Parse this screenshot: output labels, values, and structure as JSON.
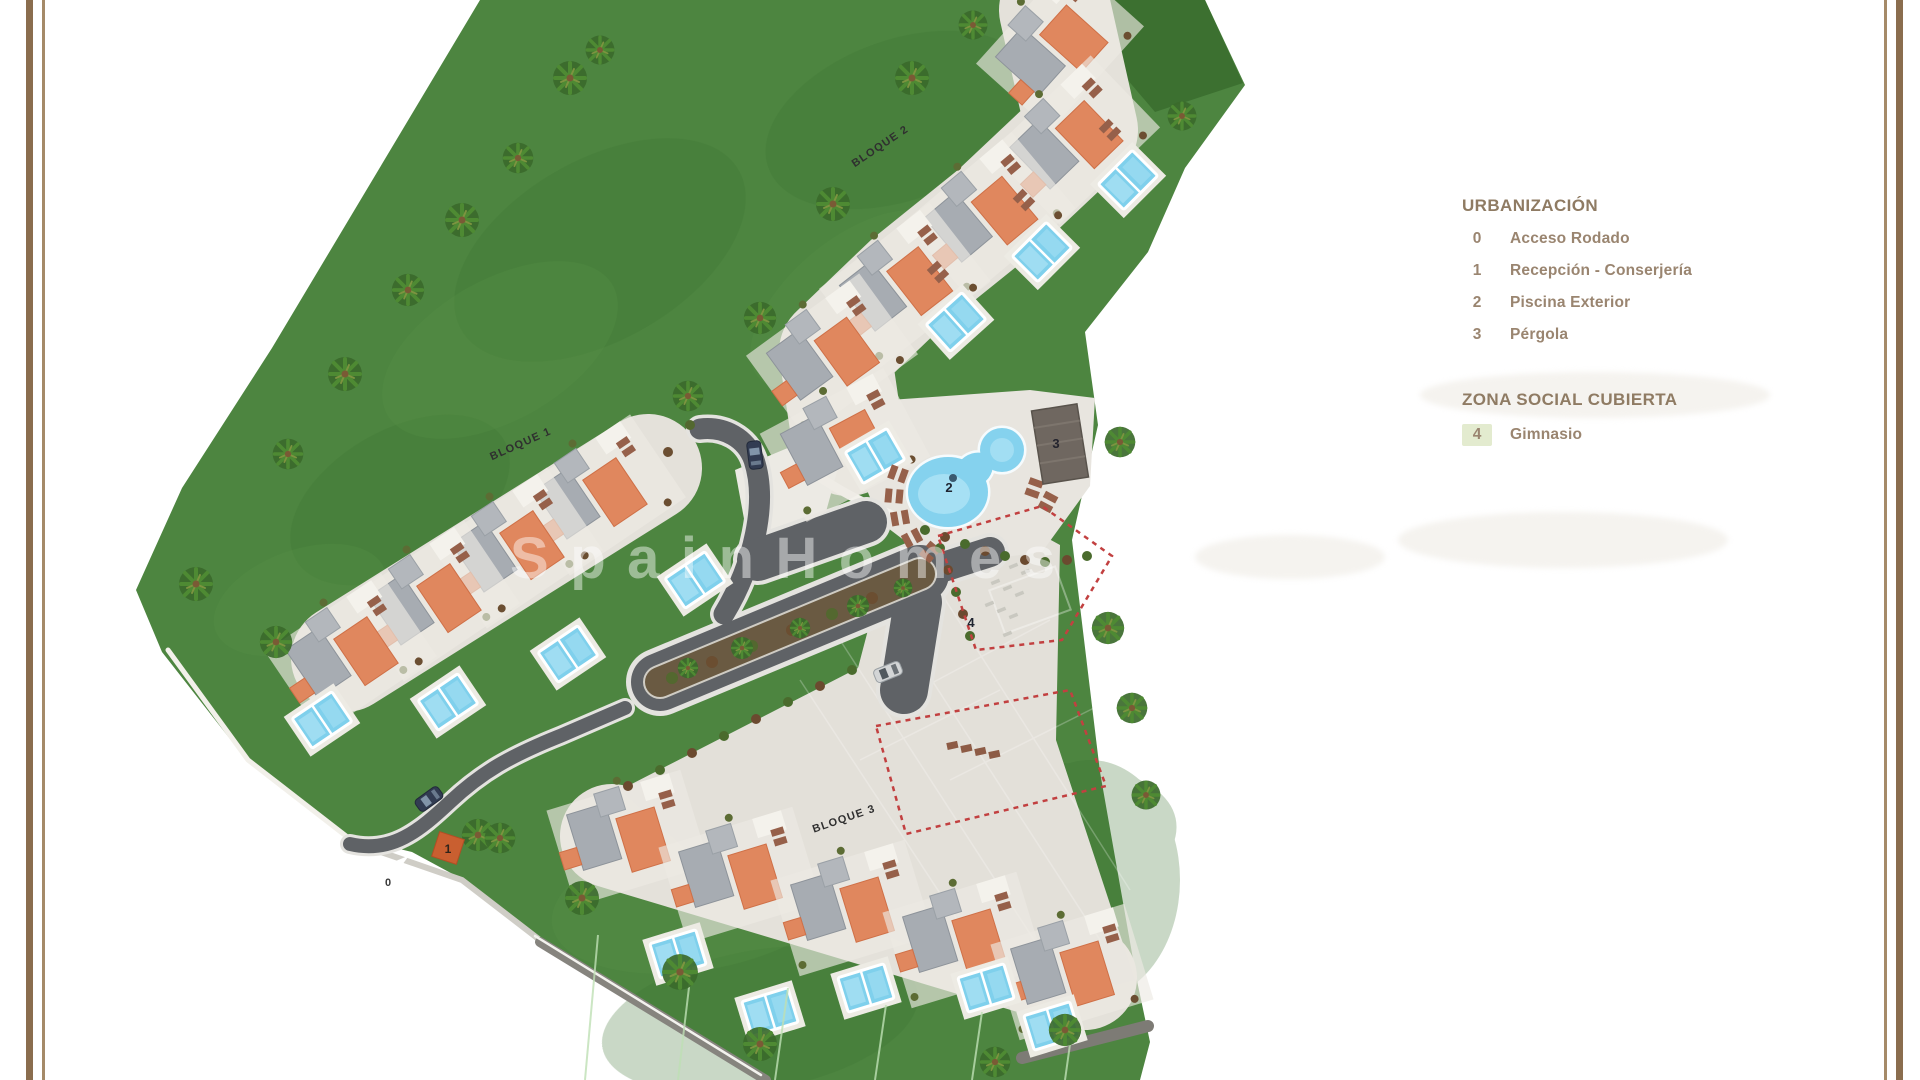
{
  "legend": {
    "title": "URBANIZACIÓN",
    "items": [
      {
        "num": "0",
        "label": "Acceso Rodado"
      },
      {
        "num": "1",
        "label": "Recepción - Conserjería"
      },
      {
        "num": "2",
        "label": "Piscina Exterior"
      },
      {
        "num": "3",
        "label": "Pérgola"
      }
    ],
    "section2_title": "ZONA SOCIAL CUBIERTA",
    "section2_items": [
      {
        "num": "4",
        "label": "Gimnasio"
      }
    ]
  },
  "plan": {
    "block_labels": [
      "BLOQUE 1",
      "BLOQUE 2",
      "BLOQUE 3"
    ],
    "markers": {
      "m0": "0",
      "m1": "1",
      "m2": "2",
      "m3": "3",
      "m4": "4"
    },
    "watermark": "SpainHomes"
  },
  "colors": {
    "frame_brown_thick": "#8a6d4e",
    "frame_brown_thin": "#a58a68",
    "lawn_green": "#4d8540",
    "dark_green_plot": "#3c7030",
    "road_gray": "#5f6266",
    "roof_gray": "#a7acb2",
    "roof_orange": "#e0875e",
    "pool_blue": "#85d2ee",
    "plaza_gray": "#e3e0d9",
    "dashed_zone_red": "#c24040",
    "reception_orange": "#c95f30",
    "legend_text": "#9a8570",
    "gym_highlight": "#e3ebcf"
  }
}
